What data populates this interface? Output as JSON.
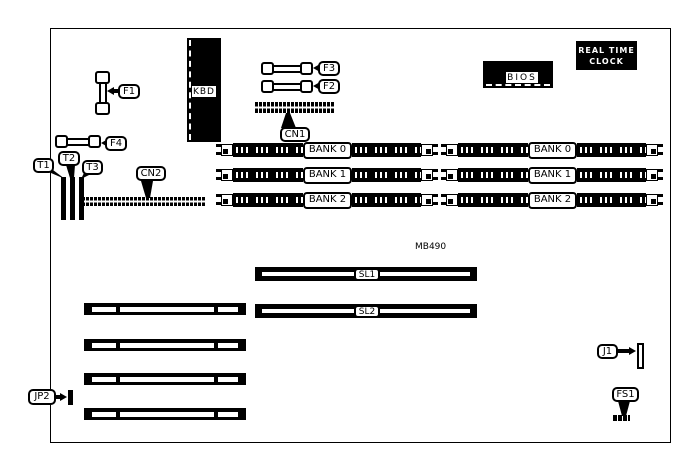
{
  "figure": {
    "model": "MB490"
  },
  "colors": {
    "ink": "#000000",
    "background": "#ffffff"
  },
  "chips": {
    "kbd": "KBD",
    "bios": "BIOS",
    "rtc_line1": "REAL TIME",
    "rtc_line2": "CLOCK"
  },
  "callouts": {
    "f1": "F1",
    "f2": "F2",
    "f3": "F3",
    "f4": "F4",
    "t1": "T1",
    "t2": "T2",
    "t3": "T3",
    "cn1": "CN1",
    "cn2": "CN2",
    "jp2": "JP2",
    "j1": "J1",
    "fs1": "FS1",
    "sl1": "SL1",
    "sl2": "SL2"
  },
  "simm": {
    "left": [
      "BANK 0",
      "BANK 1",
      "BANK 2"
    ],
    "right": [
      "BANK 0",
      "BANK 1",
      "BANK 2"
    ]
  }
}
